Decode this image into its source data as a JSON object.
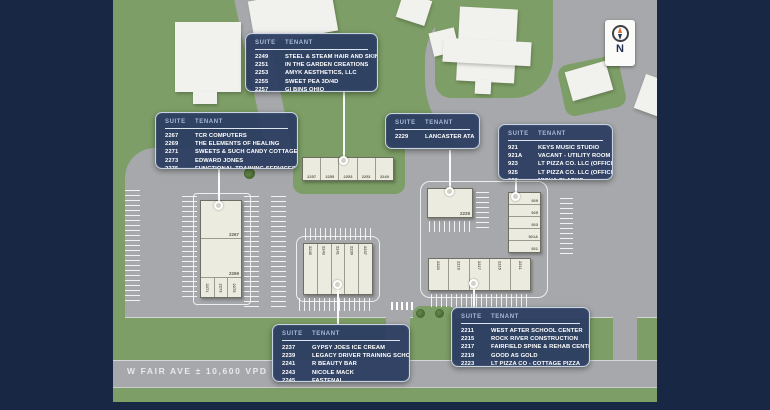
{
  "labels": {
    "suite": "SUITE",
    "tenant": "TENANT"
  },
  "road": {
    "label": "W FAIR AVE ± 10,600 VPD"
  },
  "compass": {
    "letter": "N"
  },
  "callouts": [
    {
      "name": "north-retail",
      "rows": [
        {
          "suite": "2249",
          "tenant": "STEEL & STEAM HAIR AND SKIN"
        },
        {
          "suite": "2251",
          "tenant": "IN THE GARDEN CREATIONS"
        },
        {
          "suite": "2253",
          "tenant": "AMYK AESTHETICS, LLC"
        },
        {
          "suite": "2255",
          "tenant": "SWEET PEA 3D/4D"
        },
        {
          "suite": "2257",
          "tenant": "GI BINS OHIO"
        }
      ]
    },
    {
      "name": "west-retail",
      "rows": [
        {
          "suite": "2267",
          "tenant": "TCR COMPUTERS"
        },
        {
          "suite": "2269",
          "tenant": "THE ELEMENTS OF HEALING"
        },
        {
          "suite": "2271",
          "tenant": "SWEETS & SUCH CANDY COTTAGE"
        },
        {
          "suite": "2273",
          "tenant": "EDWARD JONES"
        },
        {
          "suite": "2275",
          "tenant": "FUNCTIONAL TRAINING SERVICES"
        }
      ]
    },
    {
      "name": "center-single",
      "rows": [
        {
          "suite": "2229",
          "tenant": "LANCASTER ATA"
        }
      ]
    },
    {
      "name": "east-retail",
      "rows": [
        {
          "suite": "921",
          "tenant": "KEYS MUSIC STUDIO"
        },
        {
          "suite": "921A",
          "tenant": "VACANT - UTILITY ROOM"
        },
        {
          "suite": "923",
          "tenant": "LT PIZZA CO. LLC (OFFICE)"
        },
        {
          "suite": "925",
          "tenant": "LT PIZZA CO. LLC (OFFICE)"
        },
        {
          "suite": "929",
          "tenant": "MISHA CLARKE"
        }
      ]
    },
    {
      "name": "south-center-retail",
      "rows": [
        {
          "suite": "2237",
          "tenant": "GYPSY JOES ICE CREAM"
        },
        {
          "suite": "2239",
          "tenant": "LEGACY DRIVER TRAINING SCHOOL"
        },
        {
          "suite": "2241",
          "tenant": "R BEAUTY BAR"
        },
        {
          "suite": "2243",
          "tenant": "NICOLE MACK"
        },
        {
          "suite": "2245",
          "tenant": "FASTENAL"
        }
      ]
    },
    {
      "name": "south-east-retail",
      "rows": [
        {
          "suite": "2211",
          "tenant": "WEST AFTER SCHOOL CENTER"
        },
        {
          "suite": "2215",
          "tenant": "ROCK RIVER CONSTRUCTION"
        },
        {
          "suite": "2217",
          "tenant": "FAIRFIELD SPINE & REHAB CENTER"
        },
        {
          "suite": "2219",
          "tenant": "GOOD AS GOLD"
        },
        {
          "suite": "2223",
          "tenant": "LT PIZZA CO - COTTAGE PIZZA"
        }
      ]
    }
  ],
  "buildings": {
    "west": {
      "section1": "2267",
      "section2": "2269",
      "small_units": [
        "2271",
        "2273",
        "2275"
      ]
    },
    "north_strip": [
      "2257",
      "2255",
      "2253",
      "2251",
      "2249"
    ],
    "center_strip": [
      "2245",
      "2243",
      "2241",
      "2239",
      "2237"
    ],
    "single": "2229",
    "south_strip": [
      "2223",
      "2219",
      "2217",
      "2215",
      "2211"
    ],
    "east_strip": [
      "929",
      "925",
      "923",
      "921A",
      "921"
    ]
  },
  "colors": {
    "frame_navy": "#182743",
    "callout_blue": "#2d3e62",
    "grass_green": "#7d9e66",
    "pavement_gray": "#a6a8ab",
    "building_beige": "#ecebdf",
    "compass_needle_orange": "#d8682e"
  }
}
